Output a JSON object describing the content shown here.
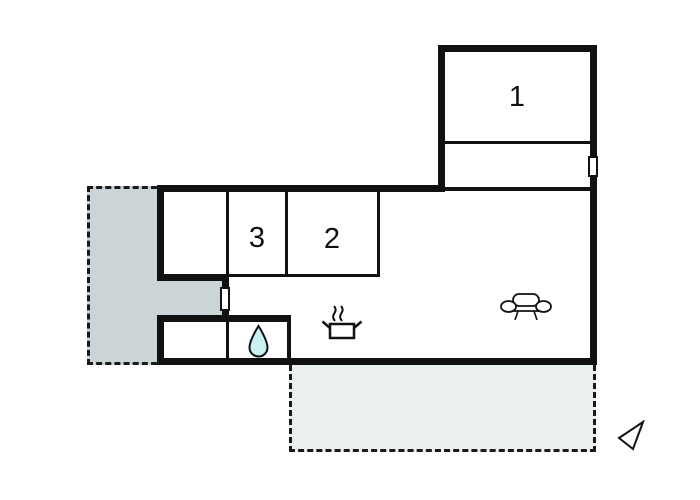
{
  "plan": {
    "room_labels": {
      "room1": "1",
      "room2": "2",
      "room3": "3"
    },
    "icons": {
      "bathroom": "water-drop-icon",
      "kitchen": "stove-pot-icon",
      "living_area": "sofa-icon",
      "orientation": "north-arrow-icon"
    },
    "colors": {
      "wall": "#111111",
      "terrace_left_fill": "#cbd5d7",
      "terrace_bottom_fill": "#e9f0ee",
      "water_drop_fill": "#c9f1f0",
      "background": "#ffffff"
    }
  }
}
